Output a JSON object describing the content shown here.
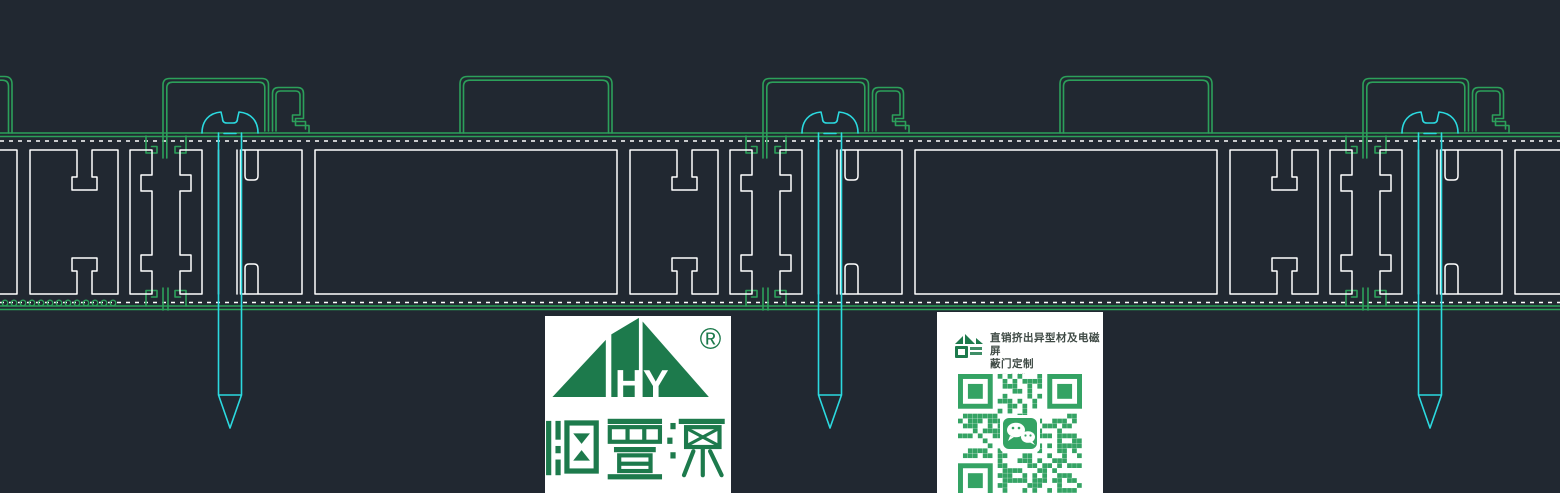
{
  "colors": {
    "background": "#212831",
    "line_white": "#ffffff",
    "line_green": "#2ca05a",
    "line_cyan": "#2bd9df",
    "logo_green": "#1d7a4c",
    "qr_green": "#34a364",
    "card_bg": "#ffffff",
    "text_dark": "#3f4a45",
    "text_muted": "#b5bab6"
  },
  "logo": {
    "monogram": "HY",
    "registered_mark": "®",
    "brand_name": "恒置源"
  },
  "qr_card": {
    "title_line1": "直销挤出异型材及电磁屏",
    "title_line2": "蔽门定制",
    "subtitle": "工厂直销"
  },
  "icons": {
    "house_logo": "house-logo-icon",
    "wechat": "wechat-icon",
    "registered": "registered-trademark-icon",
    "qr": "wechat-qr-code"
  }
}
